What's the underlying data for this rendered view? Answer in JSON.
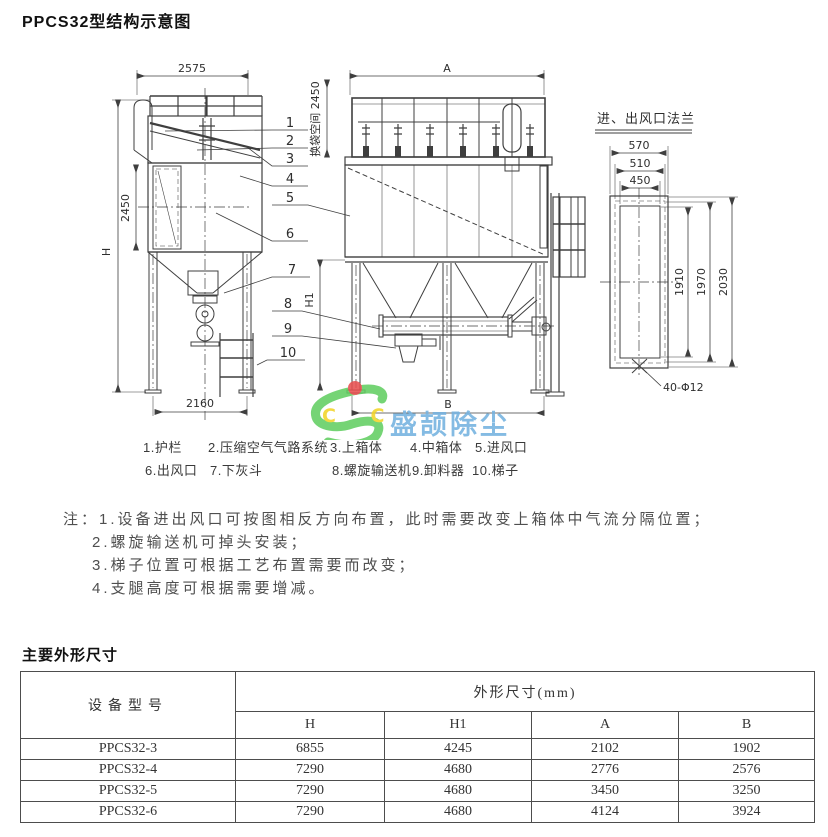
{
  "page": {
    "title": "PPCS32型结构示意图",
    "dimensions_section_title": "主要外形尺寸"
  },
  "drawing": {
    "front_view": {
      "dim_top_width": "2575",
      "dim_mid_height": "2450",
      "dim_total_height": "H",
      "dim_base_width": "2160"
    },
    "side_view": {
      "dim_bag_space": "换袋空间 2450",
      "dim_top_width": "A",
      "dim_leg_height": "H1",
      "dim_base_width": "B"
    },
    "callouts": [
      "1",
      "2",
      "3",
      "4",
      "5",
      "6",
      "7",
      "8",
      "9",
      "10"
    ],
    "flange_detail": {
      "title": "进、出风口法兰",
      "dim_w_outer": "570",
      "dim_w_bolt": "510",
      "dim_w_opening": "450",
      "dim_h_opening": "1910",
      "dim_h_bolt": "1970",
      "dim_h_outer": "2030",
      "bolt_holes": "40-Φ12"
    }
  },
  "legend": {
    "row1": [
      "1.护栏",
      "2.压缩空气气路系统",
      "3.上箱体",
      "4.中箱体",
      "5.进风口"
    ],
    "row2": [
      "6.出风口",
      "7.下灰斗",
      "8.螺旋输送机",
      "9.卸料器",
      "10.梯子"
    ]
  },
  "notes": {
    "prefix": "注：",
    "items": [
      "1.设备进出风口可按图相反方向布置，此时需要改变上箱体中气流分隔位置；",
      "2.螺旋输送机可掉头安装；",
      "3.梯子位置可根据工艺布置需要而改变；",
      "4.支腿高度可根据需要增减。"
    ]
  },
  "watermark": {
    "logo_letters": "C C",
    "name": "盛颉除尘",
    "logo_green": "#62cf62",
    "logo_yellow": "#f2d428",
    "logo_red": "#e85050",
    "name_blue": "#74b2e0"
  },
  "table": {
    "header_model": "设备型号",
    "header_dims": "外形尺寸(mm)",
    "sub_headers": [
      "H",
      "H1",
      "A",
      "B"
    ],
    "rows": [
      {
        "model": "PPCS32-3",
        "H": "6855",
        "H1": "4245",
        "A": "2102",
        "B": "1902"
      },
      {
        "model": "PPCS32-4",
        "H": "7290",
        "H1": "4680",
        "A": "2776",
        "B": "2576"
      },
      {
        "model": "PPCS32-5",
        "H": "7290",
        "H1": "4680",
        "A": "3450",
        "B": "3250"
      },
      {
        "model": "PPCS32-6",
        "H": "7290",
        "H1": "4680",
        "A": "4124",
        "B": "3924"
      }
    ]
  }
}
